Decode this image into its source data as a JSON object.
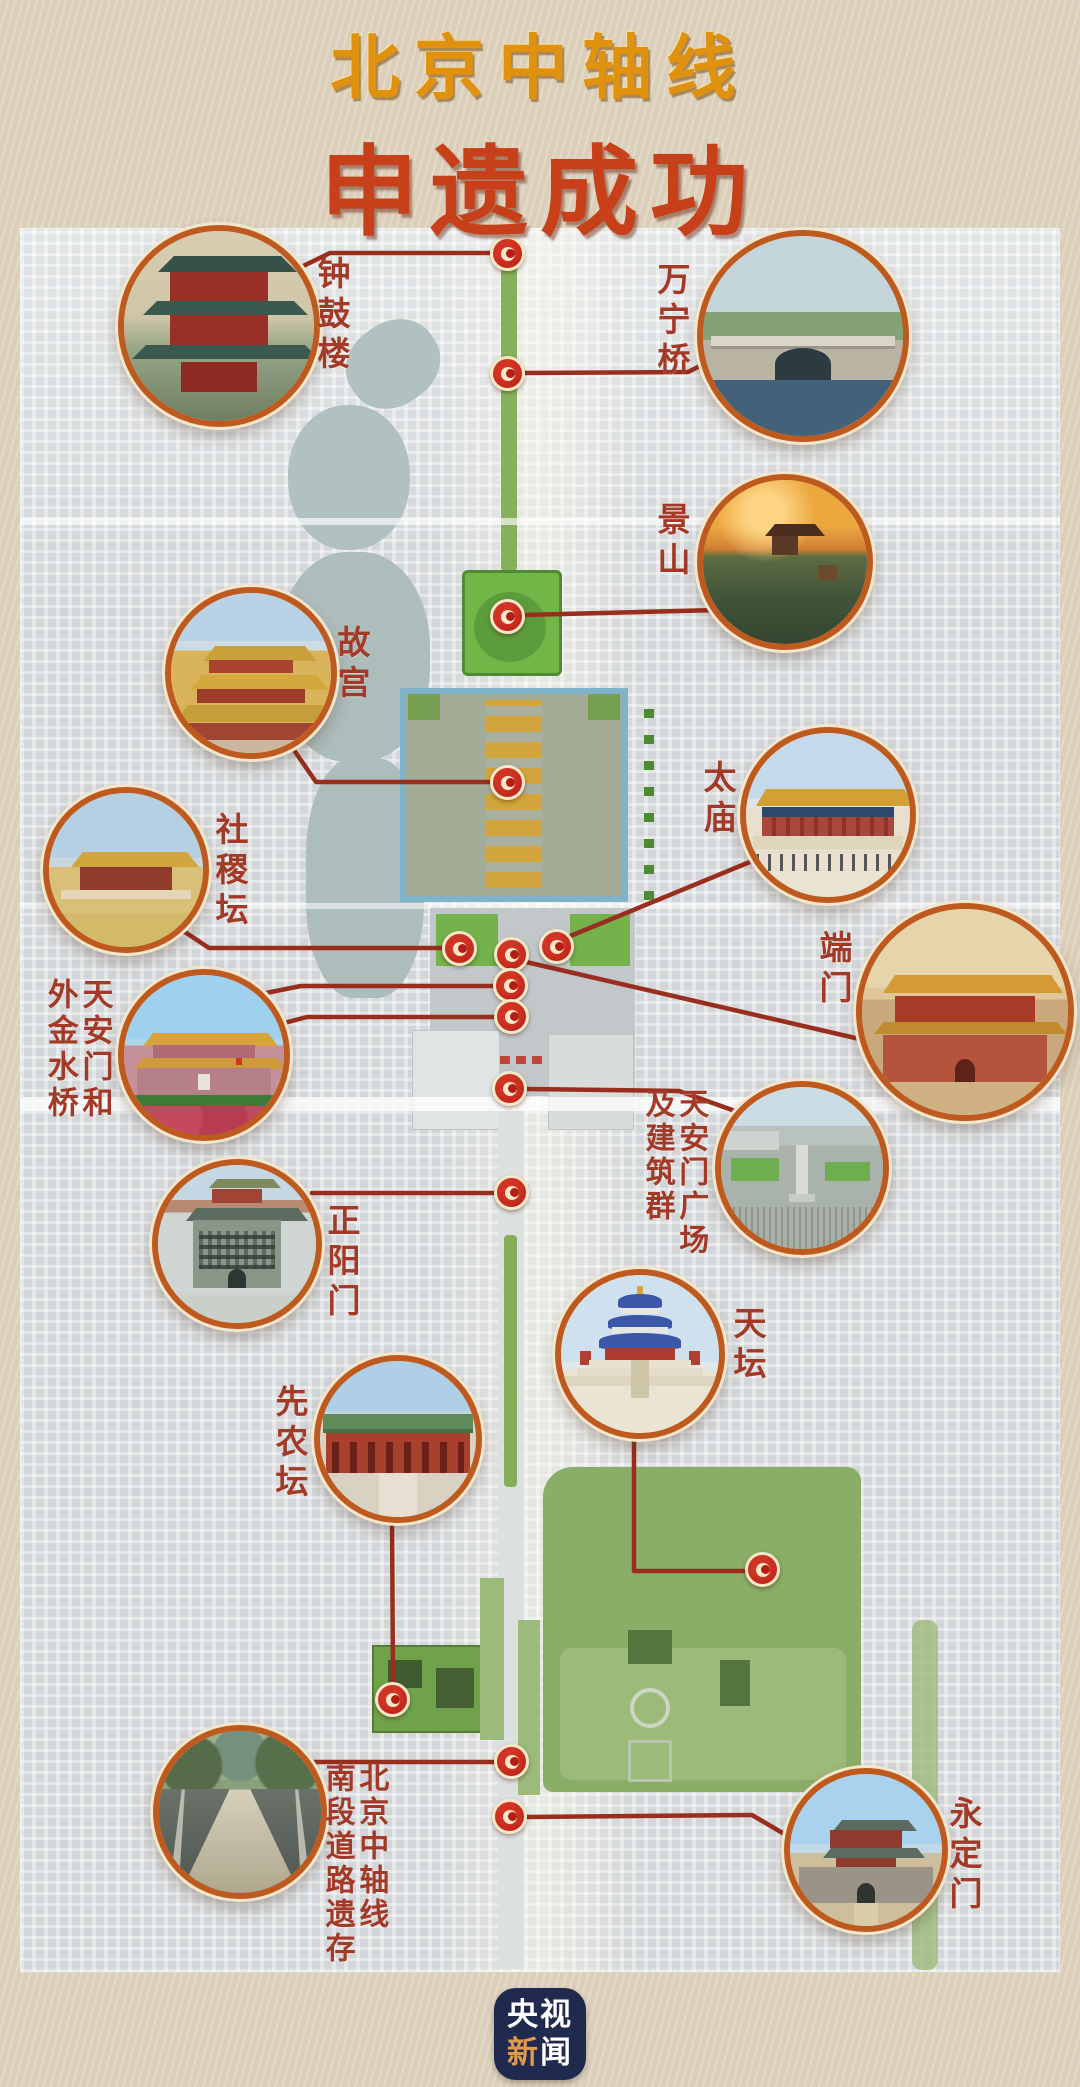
{
  "title": {
    "line1": "北京中轴线",
    "line2": "申遗成功"
  },
  "landmarks": [
    {
      "id": "zhonggulou",
      "label": "钟鼓楼"
    },
    {
      "id": "wanningqiao",
      "label": "万宁桥"
    },
    {
      "id": "jingshan",
      "label": "景山"
    },
    {
      "id": "gugong",
      "label": "故宫"
    },
    {
      "id": "shejitan",
      "label": "社稷坛"
    },
    {
      "id": "taimiao",
      "label": "太庙"
    },
    {
      "id": "duanmen",
      "label": "端门"
    },
    {
      "id": "tiananmen-waijinshuiqiao",
      "label": "天安门和外金水桥",
      "label_lines": [
        "天安门和",
        "外金水桥"
      ]
    },
    {
      "id": "tiananmen-guangchang",
      "label": "天安门广场及建筑群",
      "label_lines": [
        "天安门广场",
        "及建筑群"
      ]
    },
    {
      "id": "zhengyangmen",
      "label": "正阳门"
    },
    {
      "id": "tiantan",
      "label": "天坛"
    },
    {
      "id": "xiannongtan",
      "label": "先农坛"
    },
    {
      "id": "nanduan-daolu-yicun",
      "label": "北京中轴线南段道路遗存",
      "label_lines": [
        "北京中轴线",
        "南段道路遗存"
      ]
    },
    {
      "id": "yongdingmen",
      "label": "永定门"
    }
  ],
  "logo": {
    "top": "央视",
    "bottom_first": "新",
    "bottom_second": "闻"
  },
  "colors": {
    "title_gold": "#e0920e",
    "title_red": "#c8401a",
    "label_red": "#a33a28",
    "connector_red": "#992d1e",
    "dot_red": "#b51d13",
    "circle_border_orange": "#bf5a1f",
    "map_gray": "#d2d6d8",
    "park_green": "#72b647",
    "logo_navy": "#20294e"
  }
}
